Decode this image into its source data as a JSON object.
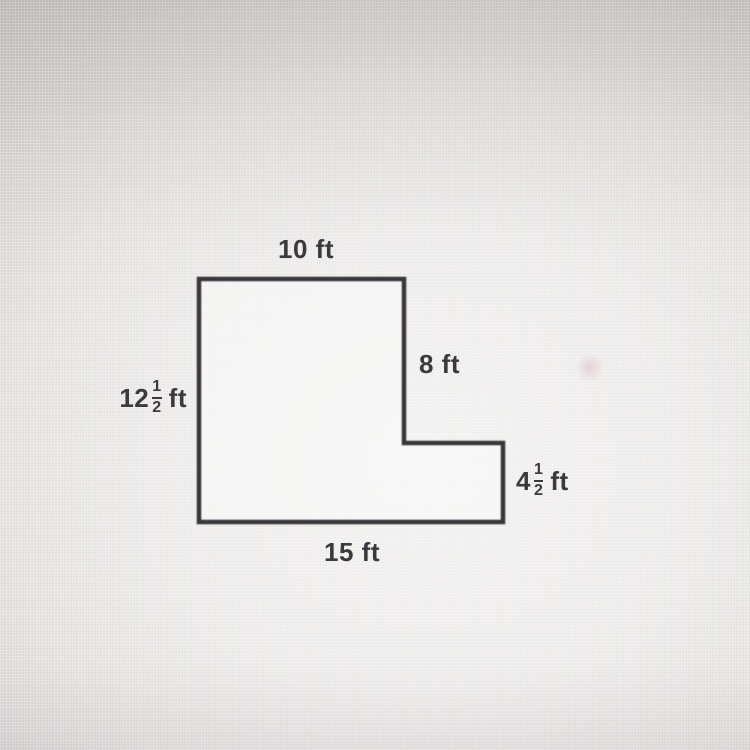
{
  "figure": {
    "shape": "L-shaped polygon",
    "line_color": "#39373b",
    "dimensions_ft": {
      "top": 10,
      "right_upper": 8,
      "left": 12.5,
      "right_lower": 4.5,
      "bottom": 15
    },
    "labels": {
      "top": "10 ft",
      "right_upper": "8 ft",
      "bottom": "15 ft",
      "left_mixed": {
        "whole": "12",
        "numerator": "1",
        "denominator": "2",
        "unit": "ft"
      },
      "right_lower_mixed": {
        "whole": "4",
        "numerator": "1",
        "denominator": "2",
        "unit": "ft"
      }
    }
  }
}
